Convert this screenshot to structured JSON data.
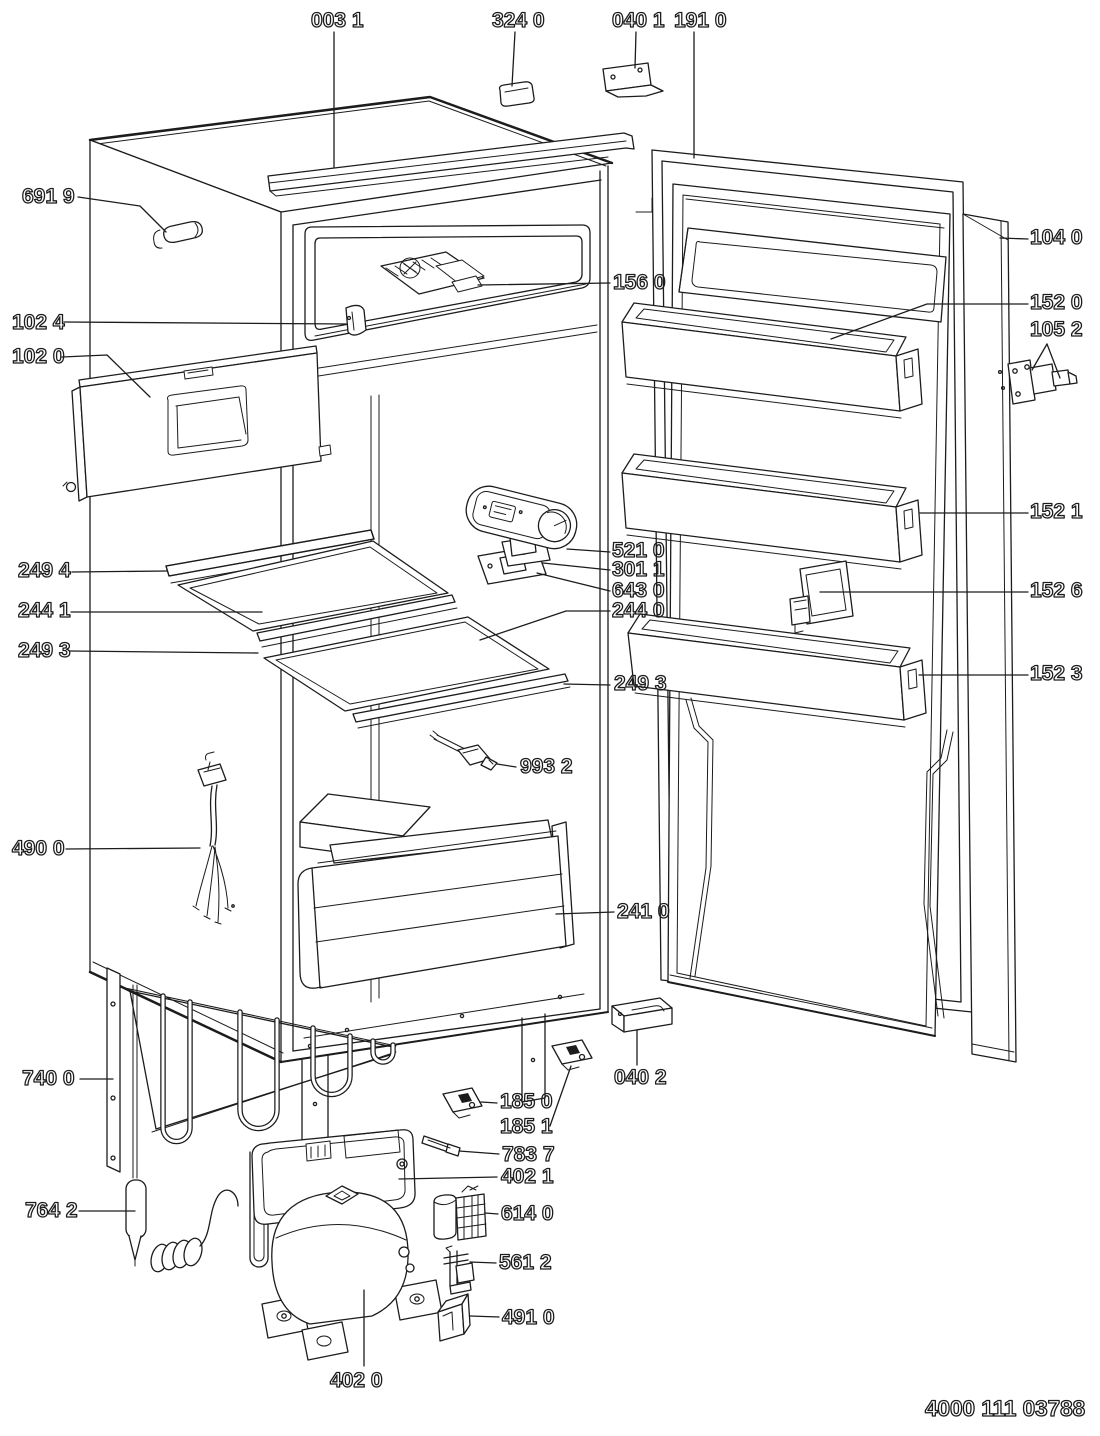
{
  "doc": {
    "code": "4000 111 03788"
  },
  "colors": {
    "line": "#1c1c1c",
    "background": "#ffffff",
    "label": "#0b0b0b"
  },
  "parts": [
    {
      "id": "003-1",
      "label": "003 1",
      "name": "top-rail-trim",
      "lx": 311,
      "ly": 10,
      "leader": [
        [
          334,
          32
        ],
        [
          334,
          167
        ]
      ]
    },
    {
      "id": "324-0",
      "label": "324 0",
      "name": "spacer-chip",
      "lx": 492,
      "ly": 10,
      "leader": [
        [
          515,
          32
        ],
        [
          512,
          86
        ]
      ]
    },
    {
      "id": "040-1",
      "label": "040 1",
      "name": "top-hinge-bracket",
      "lx": 612,
      "ly": 10,
      "leader": [
        [
          636,
          32
        ],
        [
          635,
          68
        ]
      ]
    },
    {
      "id": "191-0",
      "label": "191 0",
      "name": "door-gasket-frame",
      "lx": 674,
      "ly": 10,
      "leader": [
        [
          694,
          32
        ],
        [
          694,
          158
        ]
      ]
    },
    {
      "id": "691-9",
      "label": "691 9",
      "name": "roller-pin",
      "lx": 22,
      "ly": 186,
      "leader": [
        [
          78,
          197
        ],
        [
          140,
          206
        ],
        [
          166,
          232
        ]
      ]
    },
    {
      "id": "102-4",
      "label": "102 4",
      "name": "flap-clip",
      "lx": 12,
      "ly": 312,
      "leader": [
        [
          64,
          322
        ],
        [
          346,
          324
        ]
      ]
    },
    {
      "id": "102-0",
      "label": "102 0",
      "name": "freezer-flap",
      "lx": 12,
      "ly": 346,
      "leader": [
        [
          62,
          357
        ],
        [
          107,
          355
        ],
        [
          150,
          397
        ]
      ]
    },
    {
      "id": "249-4",
      "label": "249 4",
      "name": "shelf-front-rail",
      "lx": 18,
      "ly": 560,
      "leader": [
        [
          72,
          572
        ],
        [
          167,
          571
        ]
      ]
    },
    {
      "id": "244-1",
      "label": "244 1",
      "name": "glass-shelf-upper",
      "lx": 18,
      "ly": 600,
      "leader": [
        [
          71,
          612
        ],
        [
          262,
          612
        ]
      ]
    },
    {
      "id": "249-3-left",
      "label": "249 3",
      "name": "shelf-trim-upper",
      "lx": 18,
      "ly": 640,
      "leader": [
        [
          70,
          651
        ],
        [
          258,
          653
        ]
      ]
    },
    {
      "id": "490-0",
      "label": "490 0",
      "name": "wiring-harness",
      "lx": 12,
      "ly": 838,
      "leader": [
        [
          66,
          849
        ],
        [
          200,
          848
        ]
      ]
    },
    {
      "id": "740-0",
      "label": "740 0",
      "name": "condenser",
      "lx": 22,
      "ly": 1068,
      "leader": [
        [
          80,
          1079
        ],
        [
          113,
          1079
        ]
      ]
    },
    {
      "id": "764-2",
      "label": "764 2",
      "name": "drier-filter",
      "lx": 25,
      "ly": 1200,
      "leader": [
        [
          79,
          1211
        ],
        [
          135,
          1211
        ]
      ]
    },
    {
      "id": "402-0",
      "label": "402 0",
      "name": "compressor",
      "lx": 330,
      "ly": 1370,
      "leader": [
        [
          364,
          1366
        ],
        [
          364,
          1290
        ]
      ]
    },
    {
      "id": "156-0",
      "label": "156 0",
      "name": "ice-cube-tray",
      "lx": 613,
      "ly": 272,
      "leader": [
        [
          610,
          283
        ],
        [
          478,
          285
        ]
      ]
    },
    {
      "id": "521-0",
      "label": "521 0",
      "name": "thermostat-housing",
      "lx": 612,
      "ly": 540,
      "leader": [
        [
          610,
          552
        ],
        [
          567,
          549
        ]
      ]
    },
    {
      "id": "301-1",
      "label": "301 1",
      "name": "thermostat-bracket",
      "lx": 612,
      "ly": 559,
      "leader": [
        [
          610,
          570
        ],
        [
          543,
          563
        ]
      ]
    },
    {
      "id": "643-0",
      "label": "643 0",
      "name": "thermostat-plate",
      "lx": 612,
      "ly": 580,
      "leader": [
        [
          610,
          591
        ],
        [
          537,
          573
        ]
      ]
    },
    {
      "id": "244-0",
      "label": "244 0",
      "name": "glass-shelf-lower",
      "lx": 612,
      "ly": 600,
      "leader": [
        [
          610,
          611
        ],
        [
          566,
          611
        ],
        [
          480,
          640
        ]
      ]
    },
    {
      "id": "249-3-right",
      "label": "249 3",
      "name": "shelf-trim-lower",
      "lx": 614,
      "ly": 673,
      "leader": [
        [
          610,
          685
        ],
        [
          564,
          684
        ]
      ]
    },
    {
      "id": "993-2",
      "label": "993 2",
      "name": "temperature-sensor",
      "lx": 520,
      "ly": 756,
      "leader": [
        [
          516,
          767
        ],
        [
          497,
          764
        ]
      ]
    },
    {
      "id": "241-0",
      "label": "241 0",
      "name": "crisper-drawer",
      "lx": 617,
      "ly": 901,
      "leader": [
        [
          614,
          912
        ],
        [
          556,
          914
        ]
      ]
    },
    {
      "id": "040-2",
      "label": "040 2",
      "name": "bottom-hinge-bracket",
      "lx": 614,
      "ly": 1067,
      "leader": [
        [
          637,
          1065
        ],
        [
          637,
          1030
        ]
      ]
    },
    {
      "id": "185-0",
      "label": "185 0",
      "name": "latch-plate-a",
      "lx": 500,
      "ly": 1091,
      "leader": [
        [
          497,
          1103
        ],
        [
          481,
          1102
        ]
      ]
    },
    {
      "id": "185-1",
      "label": "185 1",
      "name": "latch-plate-b",
      "lx": 500,
      "ly": 1116,
      "leader": [
        [
          550,
          1126
        ],
        [
          571,
          1066
        ]
      ]
    },
    {
      "id": "783-7",
      "label": "783 7",
      "name": "hinge-pin",
      "lx": 502,
      "ly": 1144,
      "leader": [
        [
          499,
          1154
        ],
        [
          459,
          1151
        ]
      ]
    },
    {
      "id": "402-1",
      "label": "402 1",
      "name": "drip-tray",
      "lx": 501,
      "ly": 1166,
      "leader": [
        [
          497,
          1177
        ],
        [
          399,
          1179
        ]
      ]
    },
    {
      "id": "614-0",
      "label": "614 0",
      "name": "start-relay",
      "lx": 501,
      "ly": 1203,
      "leader": [
        [
          498,
          1214
        ],
        [
          485,
          1213
        ]
      ]
    },
    {
      "id": "561-2",
      "label": "561 2",
      "name": "overload-protector",
      "lx": 499,
      "ly": 1252,
      "leader": [
        [
          496,
          1263
        ],
        [
          470,
          1262
        ]
      ]
    },
    {
      "id": "491-0",
      "label": "491 0",
      "name": "terminal-cover",
      "lx": 502,
      "ly": 1307,
      "leader": [
        [
          499,
          1317
        ],
        [
          470,
          1316
        ]
      ]
    },
    {
      "id": "104-0",
      "label": "104 0",
      "name": "door-outer-panel",
      "lx": 1030,
      "ly": 227,
      "leader": [
        [
          1028,
          239
        ],
        [
          1000,
          238
        ]
      ]
    },
    {
      "id": "152-0",
      "label": "152 0",
      "name": "door-shelf-upper",
      "lx": 1030,
      "ly": 292,
      "leader": [
        [
          1028,
          304
        ],
        [
          927,
          304
        ],
        [
          831,
          339
        ]
      ]
    },
    {
      "id": "105-2",
      "label": "105 2",
      "name": "hinge-pin-set",
      "lx": 1030,
      "ly": 319,
      "leader": [
        [
          1047,
          344
        ],
        [
          1032,
          370
        ]
      ],
      "leader2": [
        [
          1047,
          344
        ],
        [
          1060,
          378
        ]
      ]
    },
    {
      "id": "152-1",
      "label": "152 1",
      "name": "door-shelf-middle",
      "lx": 1030,
      "ly": 501,
      "leader": [
        [
          1028,
          513
        ],
        [
          920,
          513
        ]
      ]
    },
    {
      "id": "152-6",
      "label": "152 6",
      "name": "bottle-retainer",
      "lx": 1030,
      "ly": 580,
      "leader": [
        [
          1028,
          592
        ],
        [
          820,
          592
        ]
      ]
    },
    {
      "id": "152-3",
      "label": "152 3",
      "name": "door-shelf-lower",
      "lx": 1030,
      "ly": 663,
      "leader": [
        [
          1028,
          675
        ],
        [
          919,
          675
        ]
      ]
    }
  ]
}
